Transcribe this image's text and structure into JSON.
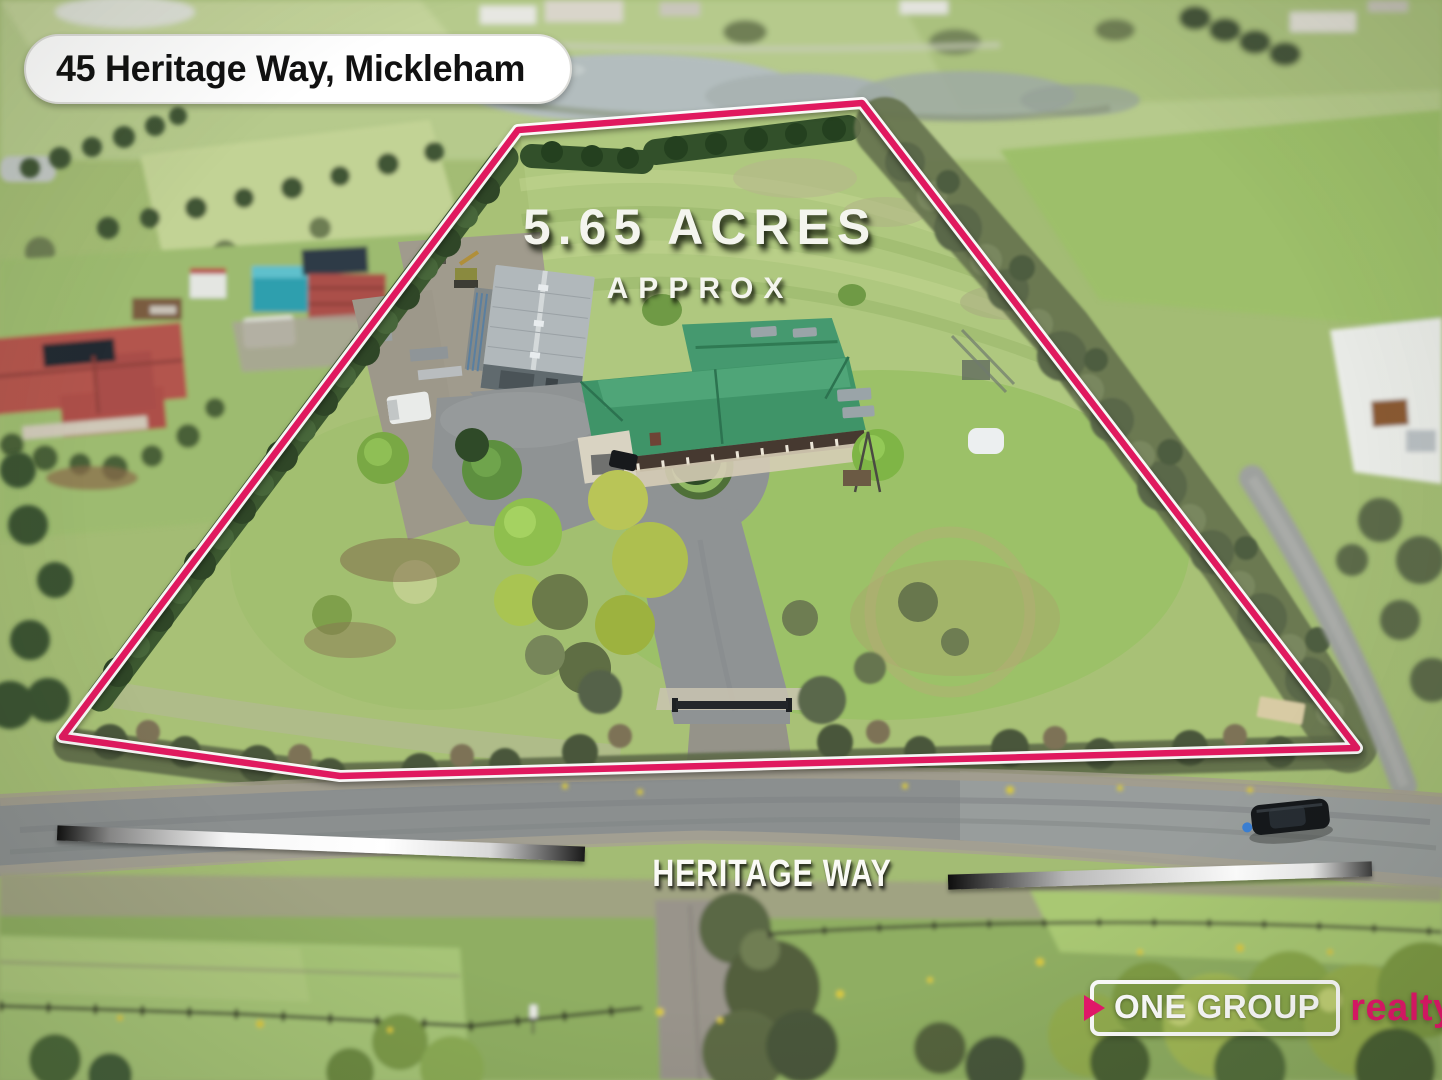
{
  "address_badge": {
    "text": "45 Heritage Way, Mickleham"
  },
  "land_size": {
    "value": "5.65 ACRES",
    "qualifier": "APPROX"
  },
  "road_label": {
    "text": "HERITAGE WAY"
  },
  "logo": {
    "brand": "ONE GROUP",
    "suffix": "realty"
  },
  "colors": {
    "boundary_pink": "#e0195f",
    "logo_pink": "#e7176c",
    "badge_bg": "#ffffff",
    "badge_text": "#111111",
    "overlay_white": "#f4f5ee"
  }
}
